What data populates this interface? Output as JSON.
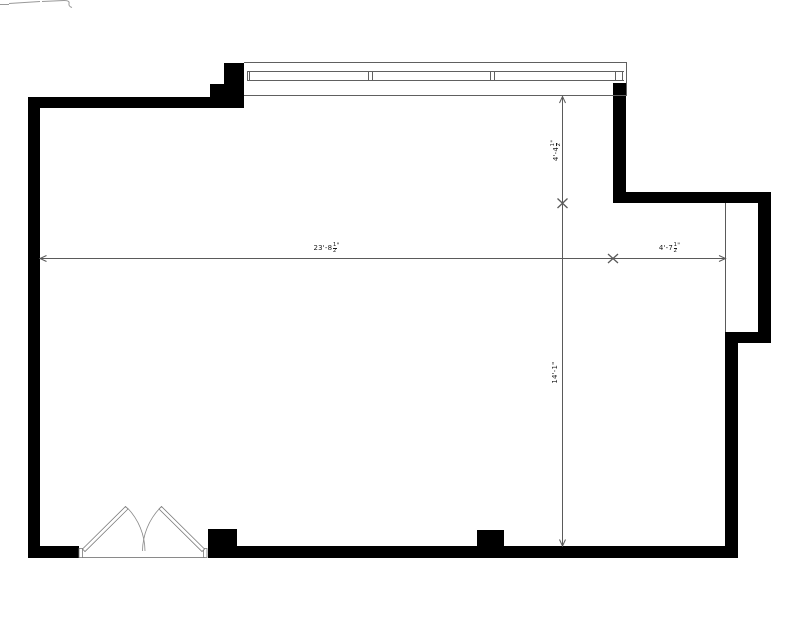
{
  "dimensions": {
    "width_left": {
      "label": "23'-8",
      "num": "1",
      "den": "2",
      "suffix": "\""
    },
    "width_right": {
      "label": "4'-7",
      "num": "1",
      "den": "2",
      "suffix": "\""
    },
    "height_upper": {
      "label": "4'-4",
      "num": "1",
      "den": "2",
      "suffix": "\""
    },
    "height_lower": {
      "label": "14'-1\""
    }
  },
  "colors": {
    "wall": "#000000",
    "dimension_line": "#5a5a5a",
    "window_line": "#606060",
    "door_line": "#7a7a7a",
    "text": "#1a1a1a"
  }
}
